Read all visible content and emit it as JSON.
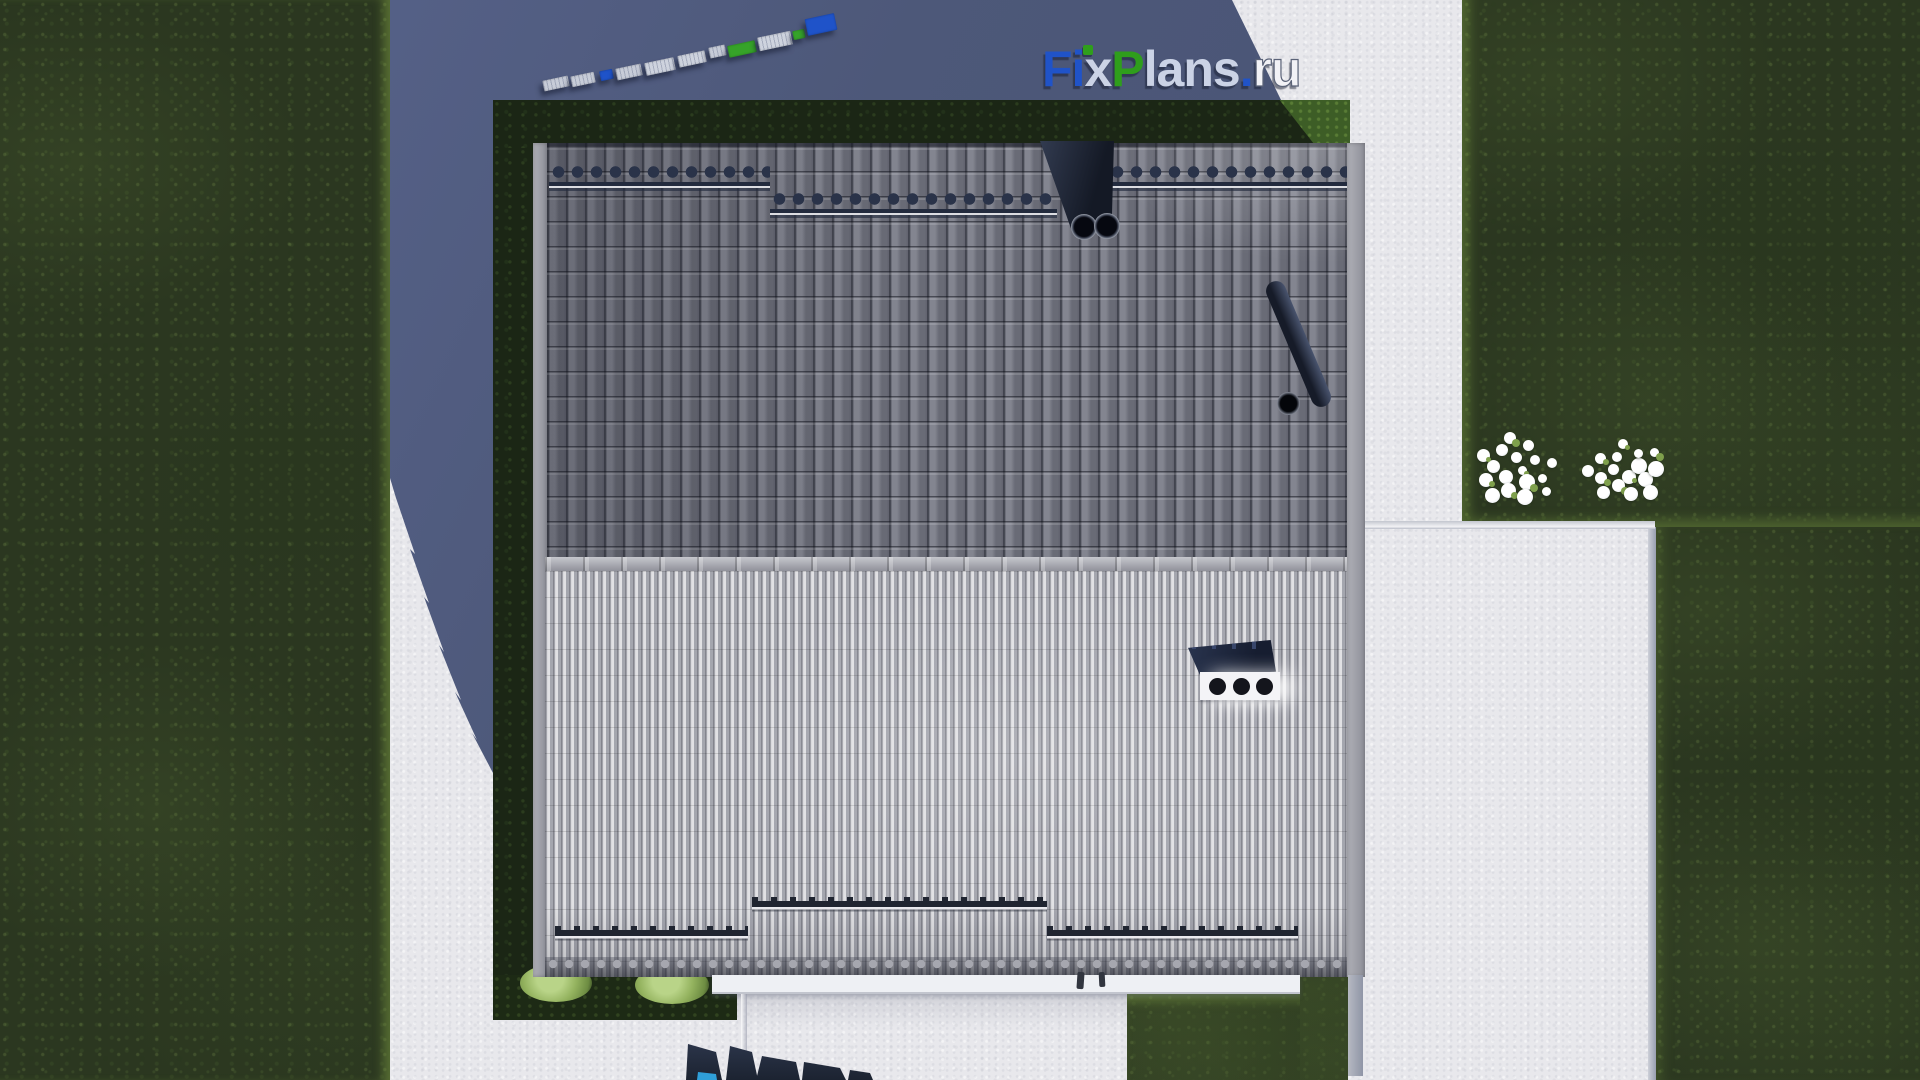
{
  "logo": {
    "f": "F",
    "i": "i",
    "x": "x",
    "p": "P",
    "lans": "lans",
    "dot": ".",
    "ru": "ru",
    "full_text": "FixPlans.ru",
    "colors": {
      "blue": "#2053c8",
      "green": "#2f9e1c",
      "silver": "#cbd3e6",
      "white": "#f2f2f6"
    }
  },
  "scene": {
    "description": "top-down architectural render of a gable-roof house",
    "colors": {
      "pavement": "#e8e8ec",
      "grass": "#2b3720",
      "cast_shadow": "#4d5879",
      "roof_upper_slope": "#757783",
      "roof_lower_slope": "#bcbdc4",
      "ridge": "#b4b5bc",
      "hedge": "#1b2615",
      "snow_guard": "#232b3e",
      "chimney": "#1c2432",
      "vent_box_face": "#f4f4f7",
      "plant_navy": "#2a3347",
      "plant_cyan": "#2f9fd8"
    },
    "counts": {
      "flower_bushes": 2,
      "garden_bushes": 2,
      "chimney_flues": 2,
      "vent_holes": 3,
      "snow_guard_rails": 3,
      "scallop_rows": 3
    },
    "pallets": [
      {
        "x": 543,
        "y": 78,
        "w": 26,
        "h": 11,
        "color": "#c7ccd8",
        "ridged": true
      },
      {
        "x": 571,
        "y": 74,
        "w": 24,
        "h": 11,
        "color": "#c7ccd8",
        "ridged": true
      },
      {
        "x": 600,
        "y": 70,
        "w": 13,
        "h": 10,
        "color": "#1f53c9",
        "ridged": false
      },
      {
        "x": 616,
        "y": 66,
        "w": 26,
        "h": 12,
        "color": "#c7ccd8",
        "ridged": true
      },
      {
        "x": 645,
        "y": 60,
        "w": 30,
        "h": 13,
        "color": "#ced3de",
        "ridged": true
      },
      {
        "x": 678,
        "y": 53,
        "w": 28,
        "h": 12,
        "color": "#ced3de",
        "ridged": true
      },
      {
        "x": 709,
        "y": 46,
        "w": 17,
        "h": 11,
        "color": "#c7ccd8",
        "ridged": true
      },
      {
        "x": 728,
        "y": 43,
        "w": 28,
        "h": 12,
        "color": "#36a329",
        "ridged": false
      },
      {
        "x": 758,
        "y": 34,
        "w": 34,
        "h": 14,
        "color": "#ced3de",
        "ridged": true
      },
      {
        "x": 793,
        "y": 30,
        "w": 12,
        "h": 9,
        "color": "#36a329",
        "ridged": false
      },
      {
        "x": 806,
        "y": 16,
        "w": 30,
        "h": 17,
        "color": "#1f53c9",
        "ridged": false
      }
    ],
    "flower_clusters": [
      {
        "cx": 1515,
        "cy": 470,
        "radius": 40,
        "petals": 17
      },
      {
        "cx": 1625,
        "cy": 472,
        "radius": 37,
        "petals": 16
      }
    ]
  }
}
